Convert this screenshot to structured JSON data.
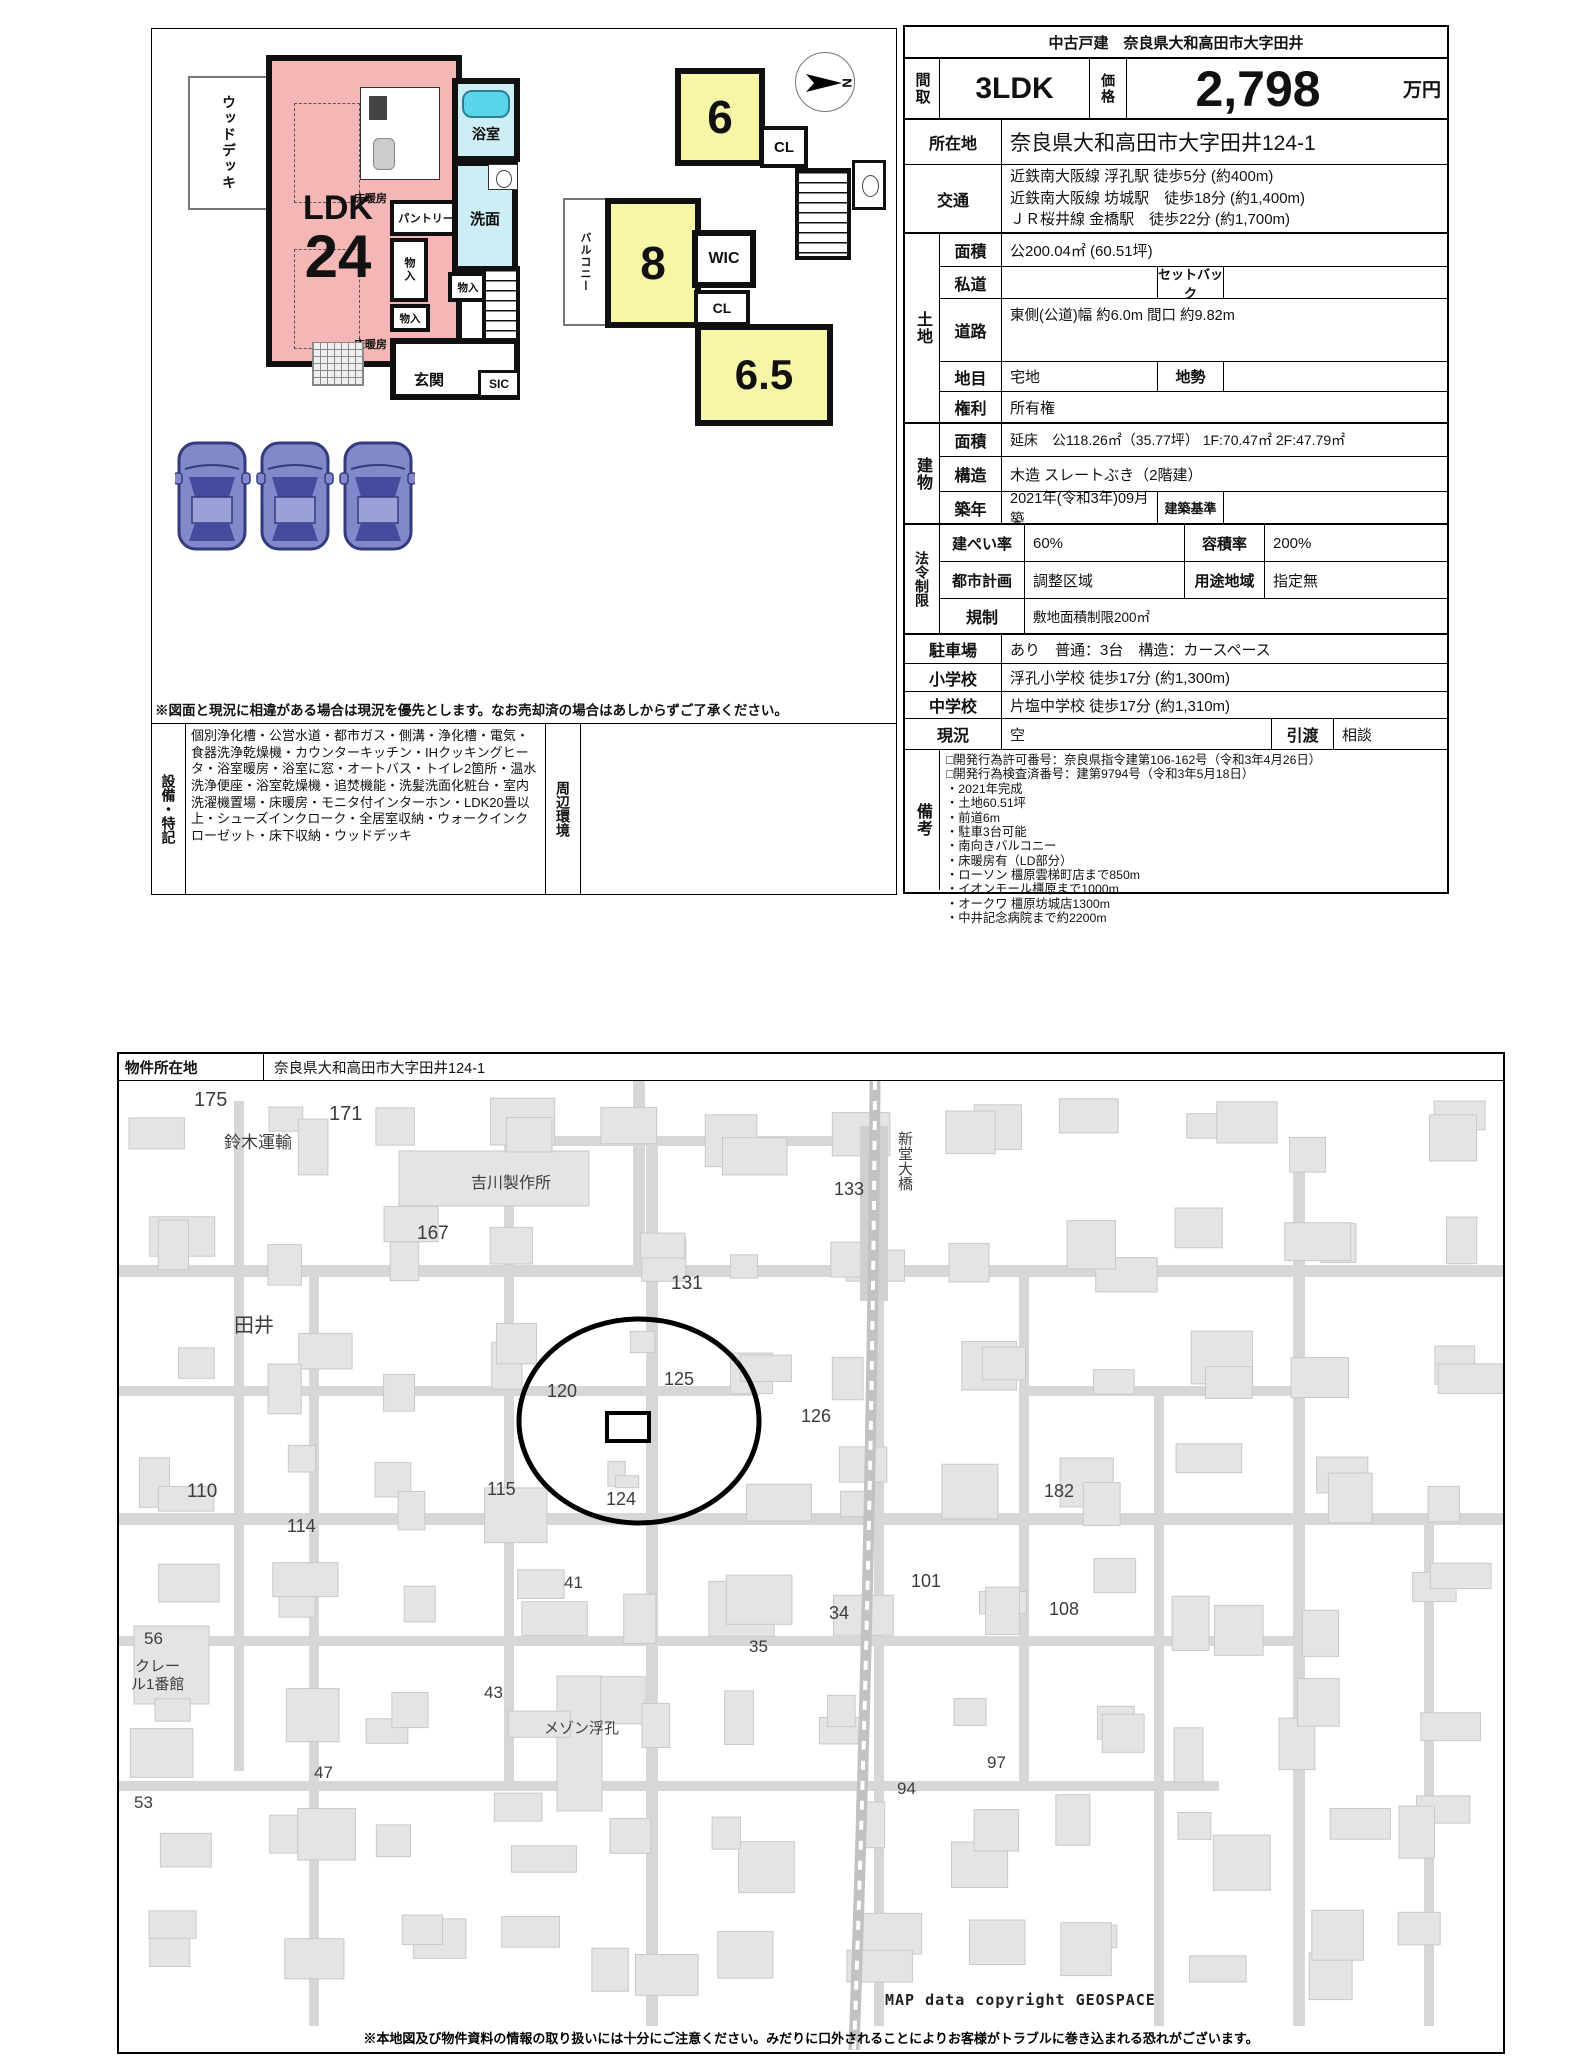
{
  "spec": {
    "title": "中古戸建　奈良県大和高田市大字田井",
    "madori_label": "間取",
    "madori": "3LDK",
    "price_label": "価格",
    "price": "2,798",
    "price_unit": "万円",
    "location_label": "所在地",
    "location": "奈良県大和高田市大字田井124-1",
    "access_label": "交通",
    "access_lines": [
      "近鉄南大阪線 浮孔駅 徒歩5分 (約400m)",
      "近鉄南大阪線 坊城駅　徒歩18分 (約1,400m)",
      "ＪＲ桜井線 金橋駅　徒歩22分 (約1,700m)"
    ],
    "land_group": "土地",
    "building_group": "建物",
    "law_group": "法令制限",
    "land_area_label": "面積",
    "land_area": "公200.04㎡ (60.51坪)",
    "private_label": "私道",
    "setback_label": "セットバック",
    "road_label": "道路",
    "road": "東側(公道)幅 約6.0m 間口 約9.82m",
    "chimoku_label": "地目",
    "chimoku": "宅地",
    "chisei_label": "地勢",
    "rights_label": "権利",
    "rights": "所有権",
    "barea_label": "面積",
    "barea": "延床　公118.26㎡（35.77坪） 1F:70.47㎡ 2F:47.79㎡",
    "structure_label": "構造",
    "structure": "木造 スレートぶき（2階建）",
    "built_label": "築年",
    "built": "2021年(令和3年)09月築",
    "standard_label": "建築基準",
    "kenpei_label": "建ぺい率",
    "kenpei": "60%",
    "yoseki_label": "容積率",
    "yoseki": "200%",
    "city_label": "都市計画",
    "city": "調整区域",
    "youto_label": "用途地域",
    "youto": "指定無",
    "kisei_label": "規制",
    "kisei": "敷地面積制限200㎡",
    "parking_label": "駐車場",
    "parking": "あり　普通：3台　構造：カースペース",
    "elem_label": "小学校",
    "elem": "浮孔小学校 徒歩17分 (約1,300m)",
    "junior_label": "中学校",
    "junior": "片塩中学校 徒歩17分 (約1,310m)",
    "status_label": "現況",
    "status": "空",
    "handover_label": "引渡",
    "handover": "相談",
    "remarks_label": "備考",
    "remarks_lines": [
      "□開発行為許可番号：奈良県指令建第106-162号（令和3年4月26日）",
      "□開発行為検査済番号：建第9794号（令和3年5月18日）",
      "・2021年完成",
      "・土地60.51坪",
      "・前道6m",
      "・駐車3台可能",
      "・南向きバルコニー",
      "・床暖房有（LD部分）",
      "・ローソン 橿原雲梯町店まで850m",
      "・イオンモール橿原まで1000m",
      "・オークワ 橿原坊城店1300m",
      "・中井記念病院まで約2200m"
    ]
  },
  "plan": {
    "f1": {
      "wood_deck": "ウッドデッキ",
      "floor_heating": "床暖房",
      "ldk": "LDK",
      "ldk_size": "24",
      "pantry": "パントリー",
      "storage": "物入",
      "bath": "浴室",
      "wash": "洗面",
      "entrance": "玄関",
      "sic": "SIC"
    },
    "f2": {
      "balcony": "バルコニー",
      "room6": "6",
      "room8": "8",
      "room65": "6.5",
      "wic": "WIC",
      "cl": "CL"
    },
    "compass_n": "N"
  },
  "equipment": {
    "label": "設備・特記",
    "text": "個別浄化槽・公営水道・都市ガス・側溝・浄化槽・電気・食器洗浄乾燥機・カウンターキッチン・IHクッキングヒータ・浴室暖房・浴室に窓・オートバス・トイレ2箇所・温水洗浄便座・浴室乾燥機・追焚機能・洗髪洗面化粧台・室内洗濯機置場・床暖房・モニタ付インターホン・LDK20畳以上・シューズインクローク・全居室収納・ウォークインクローゼット・床下収納・ウッドデッキ",
    "surround_label": "周辺環境",
    "disclaimer": "※図面と現況に相違がある場合は現況を優先とします。なお売却済の場合はあしからずご了承ください。"
  },
  "map": {
    "header_label": "物件所在地",
    "header_value": "奈良県大和高田市大字田井124-1",
    "copyright": "MAP data copyright GEOSPACE",
    "note": "※本地図及び物件資料の情報の取り扱いには十分にご注意ください。みだりに口外されることによりお客様がトラブルに巻き込まれる恐れがございます。",
    "labels": [
      {
        "t": "175",
        "x": 75,
        "y": 8,
        "s": 20
      },
      {
        "t": "171",
        "x": 210,
        "y": 22,
        "s": 20
      },
      {
        "t": "鈴木運輸",
        "x": 105,
        "y": 47,
        "s": 17
      },
      {
        "t": "吉川製作所",
        "x": 352,
        "y": 88,
        "s": 16
      },
      {
        "t": "167",
        "x": 298,
        "y": 142,
        "s": 19
      },
      {
        "t": "133",
        "x": 715,
        "y": 98,
        "s": 18
      },
      {
        "t": "新堂大橋",
        "x": 775,
        "y": 50,
        "s": 15,
        "v": 1
      },
      {
        "t": "131",
        "x": 552,
        "y": 192,
        "s": 19
      },
      {
        "t": "田井",
        "x": 115,
        "y": 228,
        "s": 20
      },
      {
        "t": "120",
        "x": 428,
        "y": 300,
        "s": 18
      },
      {
        "t": "125",
        "x": 545,
        "y": 288,
        "s": 18
      },
      {
        "t": "126",
        "x": 682,
        "y": 325,
        "s": 18
      },
      {
        "t": "115",
        "x": 368,
        "y": 398,
        "s": 18
      },
      {
        "t": "124",
        "x": 487,
        "y": 408,
        "s": 18
      },
      {
        "t": "110",
        "x": 68,
        "y": 400,
        "s": 19
      },
      {
        "t": "114",
        "x": 168,
        "y": 435,
        "s": 18
      },
      {
        "t": "182",
        "x": 925,
        "y": 400,
        "s": 18
      },
      {
        "t": "41",
        "x": 445,
        "y": 492,
        "s": 17
      },
      {
        "t": "34",
        "x": 710,
        "y": 522,
        "s": 18
      },
      {
        "t": "35",
        "x": 630,
        "y": 556,
        "s": 17
      },
      {
        "t": "101",
        "x": 792,
        "y": 490,
        "s": 18
      },
      {
        "t": "108",
        "x": 930,
        "y": 518,
        "s": 18
      },
      {
        "t": "56",
        "x": 25,
        "y": 548,
        "s": 17
      },
      {
        "t": "クレー",
        "x": 16,
        "y": 574,
        "s": 15
      },
      {
        "t": "ル1番館",
        "x": 12,
        "y": 592,
        "s": 15
      },
      {
        "t": "43",
        "x": 365,
        "y": 602,
        "s": 17
      },
      {
        "t": "メゾン浮孔",
        "x": 425,
        "y": 636,
        "s": 15
      },
      {
        "t": "47",
        "x": 195,
        "y": 682,
        "s": 17
      },
      {
        "t": "53",
        "x": 15,
        "y": 712,
        "s": 17
      },
      {
        "t": "97",
        "x": 868,
        "y": 672,
        "s": 17
      },
      {
        "t": "94",
        "x": 778,
        "y": 698,
        "s": 17
      }
    ]
  }
}
